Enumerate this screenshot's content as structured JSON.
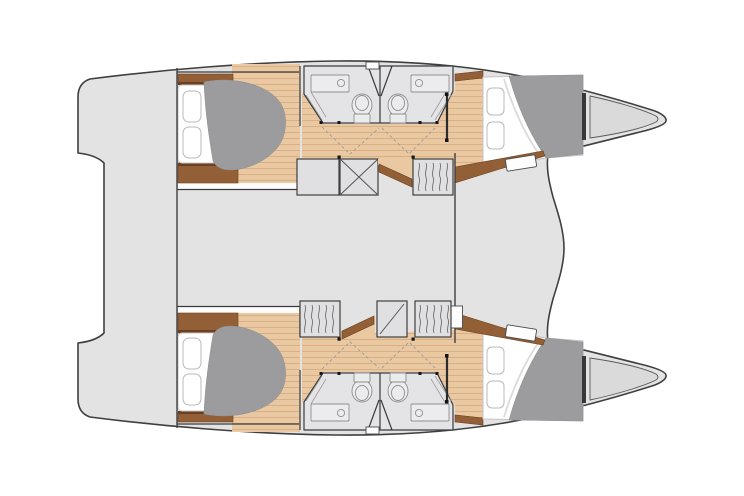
{
  "figure": {
    "kind": "catamaran-floor-plan",
    "view": "top-down, bows pointing right",
    "aria_label": "Catamaran deck plan"
  },
  "structure": {
    "hulls": 2,
    "double_berths": 4,
    "bathrooms": 4,
    "sinks": 4,
    "toilets": 4,
    "areas": [
      "aft-platform",
      "saloon-bridgedeck",
      "upper-hull",
      "lower-hull",
      "foredeck",
      "anchor-lockers"
    ]
  },
  "palette": {
    "background": "#ffffff",
    "deck": "#e3e3e4",
    "outline": "#3f3f3f",
    "module": "#e0e0e2",
    "forepeak": "#dadadb",
    "wood": "#eac9a2",
    "wood_line": "#d2ab7c",
    "trim": "#935f36",
    "trim_dark": "#6b3f1f",
    "duvet": "#9c9c9e",
    "mattress": "#ffffff",
    "fixture": "#8f8f8f",
    "wall": "#3a3a3a",
    "dot": "#151515"
  }
}
